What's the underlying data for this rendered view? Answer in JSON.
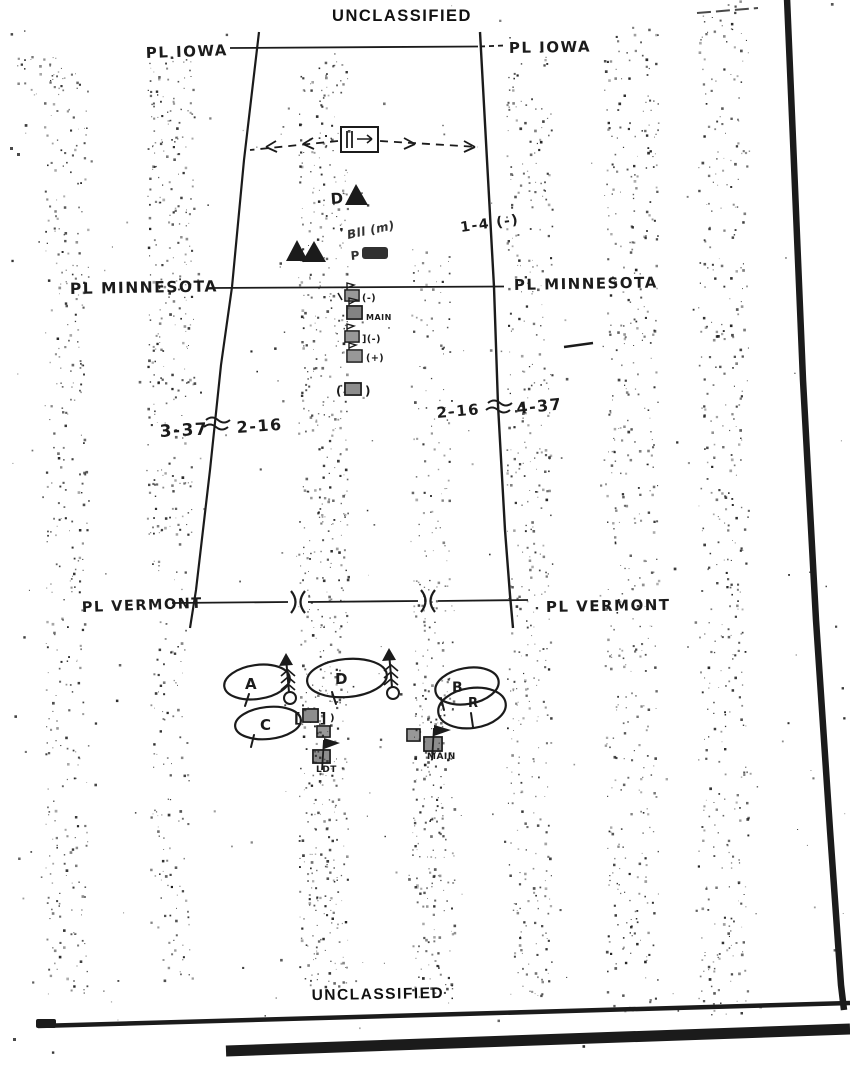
{
  "classification": {
    "top": "UNCLASSIFIED",
    "bottom": "UNCLASSIFIED"
  },
  "phase_lines": [
    {
      "name": "PL IOWA",
      "left_label": "PL IOWA",
      "right_label": "PL IOWA"
    },
    {
      "name": "PL MINNESOTA",
      "left_label": "PL MINNESOTA",
      "right_label": "PL MINNESOTA"
    },
    {
      "name": "PL VERMONT",
      "left_label": "PL VERMONT",
      "right_label": "PL VERMONT"
    }
  ],
  "boundary_labels": {
    "west": {
      "left_unit": "3-37",
      "separator": "~",
      "right_unit": "2-16"
    },
    "east": {
      "left_unit": "2-16",
      "separator": "~",
      "right_unit": "4-37"
    }
  },
  "unit_annotations": {
    "observation_post_label": "D",
    "center_scribble_line1": "Bll (m)",
    "center_scribble_line2": "P",
    "east_unit": "1-4 (-)"
  },
  "command_posts": {
    "column": [
      {
        "suffix": "(-)"
      },
      {
        "suffix": "MAIN"
      },
      {
        "suffix": "](-)"
      },
      {
        "suffix": "(+)"
      },
      {
        "prefix": "(",
        "suffix": ")"
      }
    ],
    "cluster": {
      "bracket_open": "[",
      "bracket_close": "]",
      "trailing": ")",
      "left_label": "LDT",
      "right_label": "MAIN"
    }
  },
  "assembly_areas": [
    {
      "letter": "A"
    },
    {
      "letter": "D"
    },
    {
      "letter": "B"
    },
    {
      "letter": "C"
    },
    {
      "letter": "R"
    }
  ],
  "colors": {
    "ink": "#1b1b1b",
    "paper": "#ffffff"
  }
}
